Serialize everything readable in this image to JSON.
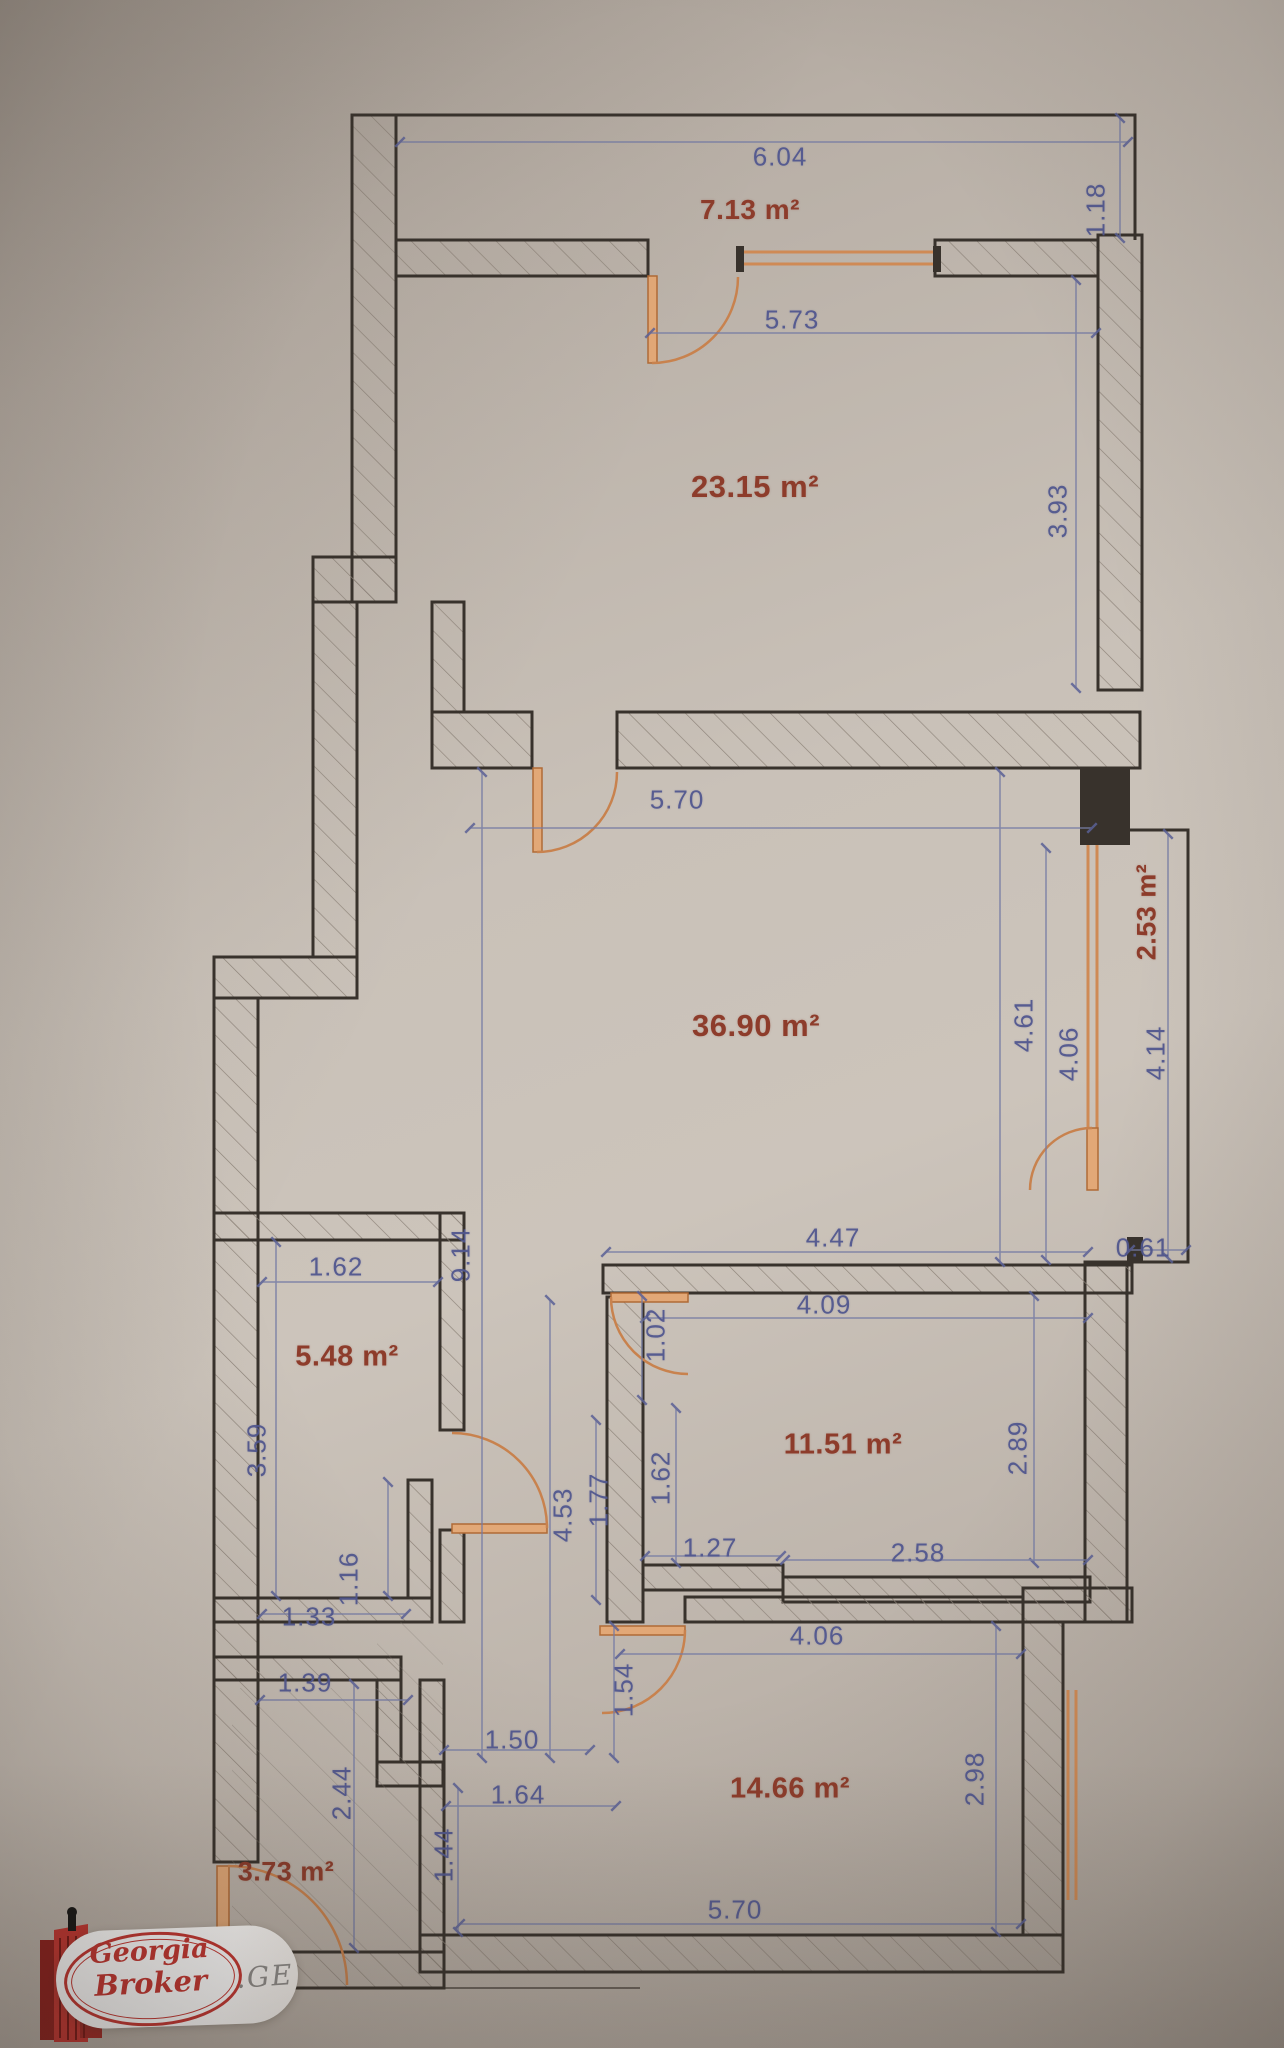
{
  "document": {
    "type": "floor-plan photo",
    "units": "m"
  },
  "colors": {
    "paper": "#c9c1b8",
    "wall_line": "#38322c",
    "hatch": "#8d8379",
    "dimension_text": "#51578f",
    "room_label_text": "#8d3c2b",
    "joinery_orange": "#c8824e",
    "logo_red": "#c63530"
  },
  "rooms": [
    {
      "label": "7.13 m²",
      "x": 750,
      "y": 210,
      "size": 28,
      "rotate": false
    },
    {
      "label": "23.15 m²",
      "x": 755,
      "y": 487,
      "size": 31,
      "rotate": false
    },
    {
      "label": "36.90 m²",
      "x": 756,
      "y": 1026,
      "size": 31,
      "rotate": false
    },
    {
      "label": "2.53 m²",
      "x": 1147,
      "y": 912,
      "size": 27,
      "rotate": true
    },
    {
      "label": "5.48 m²",
      "x": 347,
      "y": 1357,
      "size": 29,
      "rotate": false
    },
    {
      "label": "11.51 m²",
      "x": 843,
      "y": 1445,
      "size": 29,
      "rotate": false
    },
    {
      "label": "14.66 m²",
      "x": 790,
      "y": 1789,
      "size": 29,
      "rotate": false
    },
    {
      "label": "3.73 m²",
      "x": 286,
      "y": 1872,
      "size": 27,
      "rotate": false
    }
  ],
  "dimensions": [
    {
      "value": "6.04",
      "x": 780,
      "y": 157,
      "rotate": false
    },
    {
      "value": "1.18",
      "x": 1096,
      "y": 210,
      "rotate": true
    },
    {
      "value": "5.73",
      "x": 792,
      "y": 320,
      "rotate": false
    },
    {
      "value": "3.93",
      "x": 1058,
      "y": 511,
      "rotate": true
    },
    {
      "value": "5.70",
      "x": 677,
      "y": 800,
      "rotate": false
    },
    {
      "value": "4.61",
      "x": 1024,
      "y": 1025,
      "rotate": true
    },
    {
      "value": "4.06",
      "x": 1069,
      "y": 1054,
      "rotate": true
    },
    {
      "value": "4.14",
      "x": 1156,
      "y": 1053,
      "rotate": true
    },
    {
      "value": "9.14",
      "x": 461,
      "y": 1255,
      "rotate": true
    },
    {
      "value": "1.62",
      "x": 336,
      "y": 1267,
      "rotate": false
    },
    {
      "value": "3.59",
      "x": 257,
      "y": 1450,
      "rotate": true
    },
    {
      "value": "4.47",
      "x": 833,
      "y": 1238,
      "rotate": false
    },
    {
      "value": "4.09",
      "x": 824,
      "y": 1305,
      "rotate": false
    },
    {
      "value": "0.61",
      "x": 1143,
      "y": 1248,
      "rotate": false
    },
    {
      "value": "1.02",
      "x": 656,
      "y": 1335,
      "rotate": true
    },
    {
      "value": "2.89",
      "x": 1018,
      "y": 1448,
      "rotate": true
    },
    {
      "value": "1.62",
      "x": 661,
      "y": 1478,
      "rotate": true
    },
    {
      "value": "1.77",
      "x": 599,
      "y": 1500,
      "rotate": true
    },
    {
      "value": "4.53",
      "x": 563,
      "y": 1515,
      "rotate": true
    },
    {
      "value": "1.27",
      "x": 710,
      "y": 1548,
      "rotate": false
    },
    {
      "value": "2.58",
      "x": 918,
      "y": 1553,
      "rotate": false
    },
    {
      "value": "1.16",
      "x": 349,
      "y": 1579,
      "rotate": true
    },
    {
      "value": "1.33",
      "x": 309,
      "y": 1617,
      "rotate": false
    },
    {
      "value": "1.39",
      "x": 305,
      "y": 1683,
      "rotate": false
    },
    {
      "value": "4.06",
      "x": 817,
      "y": 1636,
      "rotate": false
    },
    {
      "value": "1.54",
      "x": 624,
      "y": 1690,
      "rotate": true
    },
    {
      "value": "1.50",
      "x": 512,
      "y": 1740,
      "rotate": false
    },
    {
      "value": "2.44",
      "x": 342,
      "y": 1793,
      "rotate": true
    },
    {
      "value": "1.64",
      "x": 518,
      "y": 1795,
      "rotate": false
    },
    {
      "value": "1.44",
      "x": 444,
      "y": 1855,
      "rotate": true
    },
    {
      "value": "2.98",
      "x": 975,
      "y": 1779,
      "rotate": true
    },
    {
      "value": "5.70",
      "x": 735,
      "y": 1910,
      "rotate": false
    }
  ],
  "logo": {
    "line1": "Georgia",
    "line2": "Broker",
    "suffix": ".GE"
  }
}
